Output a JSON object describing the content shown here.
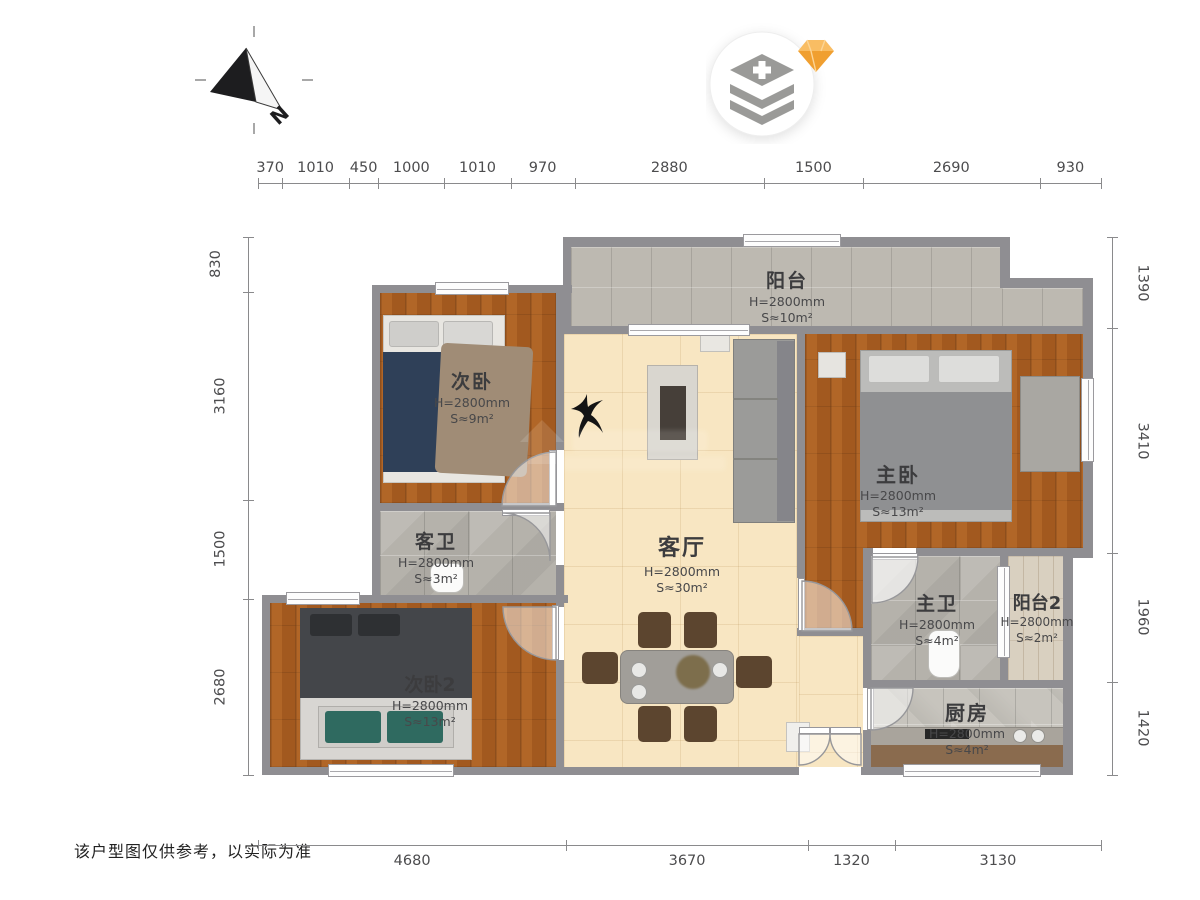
{
  "compass": {
    "north_label": "N"
  },
  "dims": {
    "top": [
      "370",
      "1010",
      "450",
      "1000",
      "1010",
      "970",
      "2880",
      "1500",
      "2690",
      "930"
    ],
    "left": [
      "830",
      "3160",
      "1500",
      "2680"
    ],
    "right": [
      "1390",
      "3410",
      "1960",
      "1420"
    ],
    "bottom": [
      "4680",
      "3670",
      "1320",
      "3130"
    ]
  },
  "rooms": {
    "balcony": {
      "name": "阳台",
      "height": "H=2800mm",
      "area": "S≈10m²"
    },
    "bedroom2": {
      "name": "次卧",
      "height": "H=2800mm",
      "area": "S≈9m²"
    },
    "master_bedroom": {
      "name": "主卧",
      "height": "H=2800mm",
      "area": "S≈13m²"
    },
    "guest_bath": {
      "name": "客卫",
      "height": "H=2800mm",
      "area": "S≈3m²"
    },
    "living_room": {
      "name": "客厅",
      "height": "H=2800mm",
      "area": "S≈30m²"
    },
    "master_bath": {
      "name": "主卫",
      "height": "H=2800mm",
      "area": "S≈4m²"
    },
    "balcony2": {
      "name": "阳台2",
      "height": "H=2800mm",
      "area": "S≈2m²"
    },
    "bedroom3": {
      "name": "次卧2",
      "height": "H=2800mm",
      "area": "S≈13m²"
    },
    "kitchen": {
      "name": "厨房",
      "height": "H=2800mm",
      "area": "S≈4m²"
    }
  },
  "disclaimer": "该户型图仅供参考，以实际为准",
  "colors": {
    "wall": "#8f8e92",
    "wood": "#a2591f",
    "living_floor": "#f8e6c2",
    "tile": "#b5b2ab",
    "gem": "#f5a83c",
    "icon_gray": "#9a9a98"
  }
}
